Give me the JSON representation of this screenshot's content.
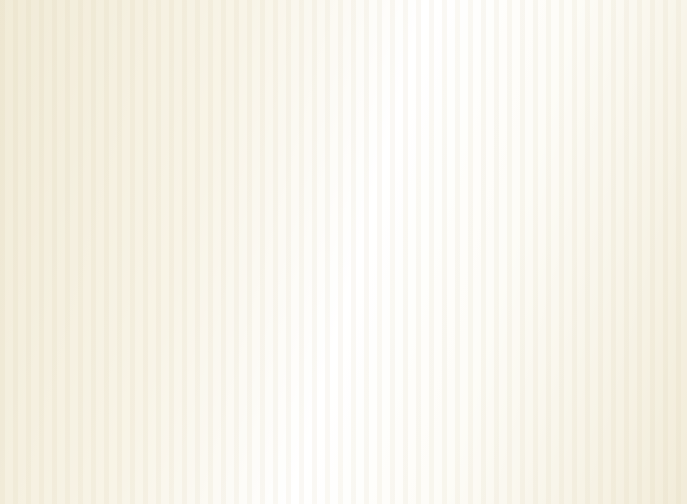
{
  "meta": {
    "title": "3D isometric apartment floor plan render",
    "style": "photorealistic cutaway dollhouse view, no visible text"
  },
  "palette": {
    "tile_main": "#f2ebd8",
    "tile_grout": "#ddd2b4",
    "tile_bath": "#e9dbba",
    "tile_balc": "#eae3ca",
    "wood_floor": "#a35b22",
    "wood_line": "#7e4318",
    "wall_top": "#f8f5ee",
    "wall_white": "#efece1",
    "wall_cream": "#eae3d3",
    "wp_gold": "#d2b26e",
    "ext_front": "#c8c2a9",
    "ext_slab": "#bfb9a0",
    "ext_slab2": "#b3ae9a",
    "ext_under": "#a6a292",
    "ext_side": "#d9d5c3",
    "dark_wood": "#5a2c24",
    "dark_wood2": "#45201a",
    "mid_wood": "#7a4a28",
    "frame_white": "#fbfaf7",
    "glass": "#a9b5b9",
    "glass_blue": "#cfe0e8",
    "railing_dark": "#3a3128",
    "slat_wood": "#c17a31",
    "slat_dark": "#995c1e",
    "steel": "#9aa0a6",
    "white": "#ffffff",
    "chrome": "#dde0e2",
    "lamp_shade": "#ebd9a7",
    "sofa_gold": "#d99d4b",
    "sofa_shadow": "#c18a39",
    "sofa_side": "#b07c30",
    "sofa_trim": "#8a4c1e",
    "cushion_line": "#a87830",
    "rug_border": "#b8502f",
    "rug_center": "#ebdabd",
    "rug_center2": "#d5c59f",
    "mat_border": "#5a2a22",
    "mat_inner": "#ccba90",
    "mat_line": "#8a7450",
    "stripe_a": "#b9ab84",
    "stripe_b": "#e3d8b9",
    "bed2_front": "#cabc9a",
    "bed2_side": "#b8a988",
    "bed_white": "#f1ebd9",
    "master_spread": "#c9a53d",
    "spread_pink": "#d28898",
    "spread_cream": "#e9d9a1",
    "bed_skirt": "#b09a60",
    "bed_skirt2": "#9c8850",
    "gold_cushion": "#c8a858",
    "hb": "#d2bc86",
    "hb2": "#c4b68c",
    "gold_trim": "#8a6430",
    "mirror": "#c3d3cd",
    "art_tan": "#d8c49a",
    "art_cream": "#ddc99d",
    "pic_frame": "#3a241c",
    "pic_inner": "#e9dec5",
    "tv_panel": "#dac39b",
    "tv_black": "#17171c",
    "tv_screen": "#2e3540",
    "tv_gloss": "#4a5668",
    "plant_dark": "#2e5226",
    "plant_mid": "#3f7a30",
    "plant_light": "#5d9a3c",
    "pot": "#3a2a22",
    "chair_dark": "#303036",
    "chair_dark2": "#26262a",
    "counter_top": "#ece6d8",
    "hob": "#26262a",
    "washer_side": "#e0ddd4",
    "washer_door": "#2a2e33",
    "book_white": "#e8e8e0",
    "book_red": "#a03028",
    "book_green": "#4a7040",
    "book_blue": "#30405c",
    "book_tan": "#c8c0b0",
    "book_brown": "#784830",
    "stool_side": "#ddd2b8",
    "stripe_chair_a": "#e9e1d1",
    "stripe_chair_b": "#4a4036",
    "balc_table": "#6a3424",
    "balc_table2": "#7a4030",
    "red_flower": "#c23030",
    "bowl_gold": "#c8b030"
  },
  "rooms": [
    {
      "name": "second-bedroom",
      "floor": "wood",
      "walls": "gold wallpaper",
      "features": [
        "striped bed",
        "two framed pictures",
        "window",
        "nightstand with lamp",
        "desk"
      ]
    },
    {
      "name": "study",
      "floor": "wood",
      "walls": "gold wallpaper",
      "features": [
        "dark bookshelf with books",
        "desk with red book and lamp",
        "office chair",
        "rug",
        "window"
      ]
    },
    {
      "name": "master-bedroom",
      "floor": "wood",
      "walls": "gold wallpaper",
      "features": [
        "floral bed",
        "woven headboard",
        "framed floral artwork",
        "round mirror",
        "dressing table with stool and lamp",
        "nightstand with lamp",
        "window wall"
      ]
    },
    {
      "name": "kitchen",
      "floor": "tile",
      "features": [
        "L-shaped counter",
        "double steel sink",
        "gas hob",
        "tall cabinet"
      ]
    },
    {
      "name": "utility-balcony",
      "floor": "tile",
      "features": [
        "washing machine",
        "ornate railing"
      ]
    },
    {
      "name": "entry",
      "floor": "tile",
      "features": [
        "patterned doormat",
        "shoe cabinet",
        "potted plant"
      ]
    },
    {
      "name": "living-dining",
      "floor": "tile",
      "features": [
        "gold fabric sofa set",
        "coffee table with runner and bowl",
        "bordered area rug",
        "dining table with plates and chairs",
        "TV feature wall with flat screen",
        "media cabinet",
        "potted plants",
        "sphere floor lamps"
      ]
    },
    {
      "name": "bathroom",
      "floor": "beige tile",
      "features": [
        "sink",
        "toilet",
        "shower with glass panel"
      ]
    },
    {
      "name": "front-balcony",
      "floor": "diamond tile",
      "features": [
        "two striped armchairs",
        "round table with flowers",
        "large potted plant",
        "ornate railing"
      ]
    },
    {
      "name": "louver-balcony",
      "features": [
        "wood slat screen"
      ]
    }
  ]
}
